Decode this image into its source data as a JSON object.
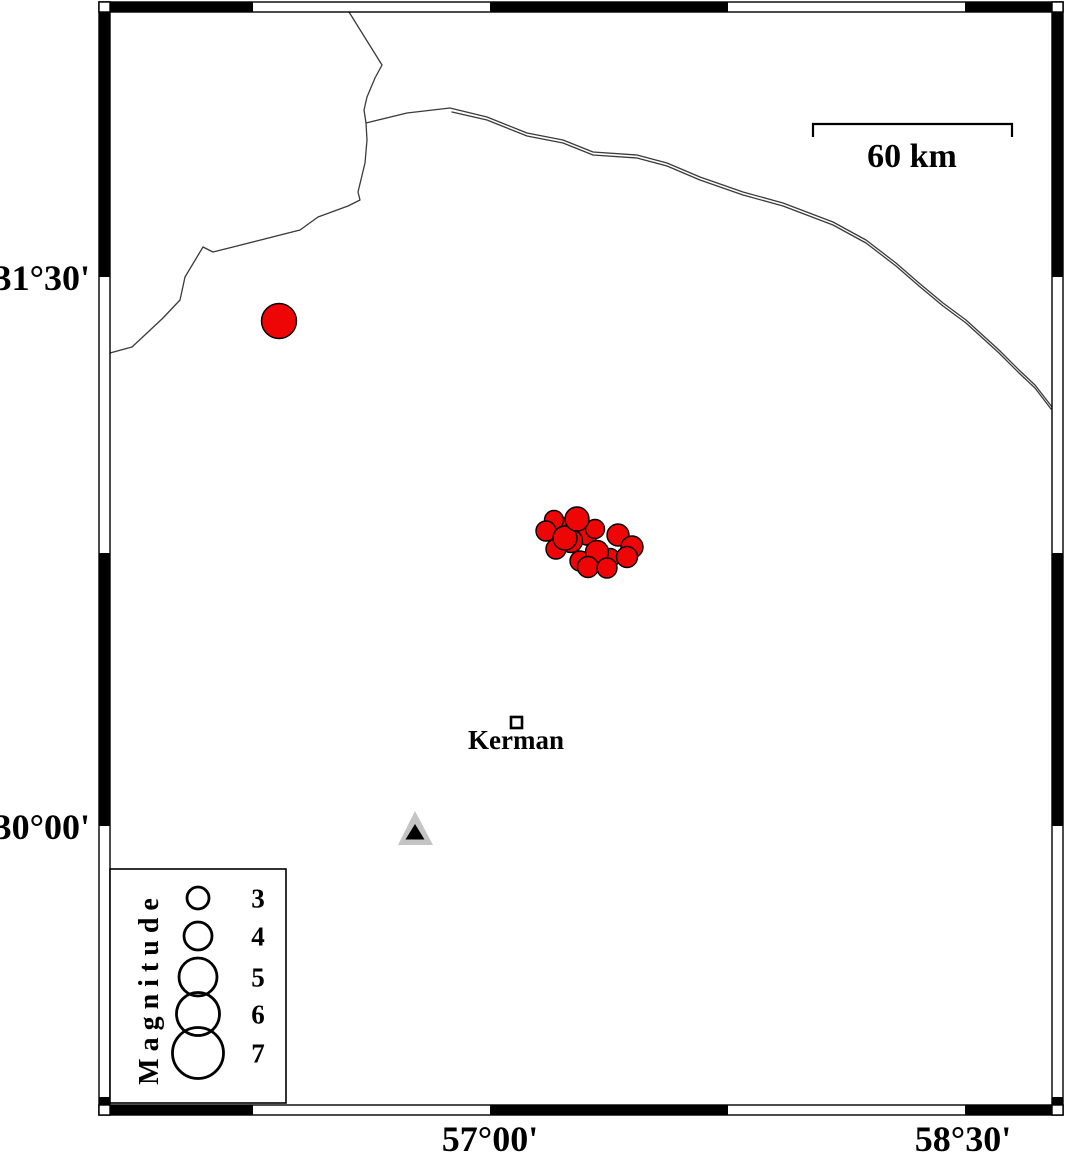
{
  "map": {
    "axis_labels": {
      "lat_top": "31°30'",
      "lat_bottom": "30°00'",
      "lon_left": "57°00'",
      "lon_right": "58°30'"
    },
    "scale_bar": {
      "label": "60 km",
      "length_km": 60,
      "x1": 813,
      "x2": 1012,
      "y": 124,
      "tick_drop": 13
    },
    "city": {
      "name": "Kerman",
      "x": 516,
      "y": 722
    },
    "station": {
      "outer": "415,811 398,845 433,845",
      "inner": "415,824 405.5,839.5 424.5,839.5"
    },
    "colors": {
      "epicenter_fill": "#ee0505",
      "station_gray": "#c4c4c4",
      "fault_line": "#3a3a3a"
    },
    "epicenters": [
      [
        279,
        321,
        17.5
      ],
      [
        561,
        527,
        9.5
      ],
      [
        554,
        520,
        9.5
      ],
      [
        546,
        531,
        10
      ],
      [
        587,
        535,
        10
      ],
      [
        595,
        529,
        9.5
      ],
      [
        571,
        541,
        11.5
      ],
      [
        556,
        549,
        10
      ],
      [
        610,
        558,
        9.5
      ],
      [
        580,
        561,
        10
      ],
      [
        565,
        538,
        12
      ],
      [
        618,
        535,
        11
      ],
      [
        632,
        547,
        11
      ],
      [
        627,
        557,
        10.5
      ],
      [
        597,
        552,
        11.5
      ],
      [
        577,
        519,
        12
      ],
      [
        588,
        567,
        10.5
      ],
      [
        607,
        568,
        10
      ]
    ],
    "faults": {
      "a": [
        [
          349,
          12
        ],
        [
          382,
          65
        ],
        [
          375,
          78
        ],
        [
          367,
          97
        ],
        [
          364,
          110
        ],
        [
          366,
          123
        ],
        [
          367,
          140
        ],
        [
          365,
          163
        ],
        [
          358,
          192
        ],
        [
          360,
          200
        ],
        [
          348,
          206
        ],
        [
          318,
          217
        ],
        [
          300,
          230
        ],
        [
          233,
          247
        ],
        [
          213,
          252
        ],
        [
          203,
          247
        ],
        [
          185,
          277
        ],
        [
          180,
          300
        ],
        [
          163,
          318
        ],
        [
          147,
          333
        ],
        [
          132,
          347
        ],
        [
          110,
          353
        ]
      ],
      "b": [
        [
          366,
          123
        ],
        [
          407,
          113
        ],
        [
          450,
          108
        ],
        [
          487,
          117
        ],
        [
          527,
          133
        ],
        [
          563,
          140
        ],
        [
          593,
          152
        ],
        [
          637,
          155
        ],
        [
          667,
          163
        ],
        [
          700,
          177
        ],
        [
          743,
          192
        ],
        [
          783,
          203
        ],
        [
          833,
          222
        ],
        [
          866,
          240
        ],
        [
          896,
          263
        ],
        [
          919,
          283
        ],
        [
          943,
          303
        ],
        [
          966,
          320
        ],
        [
          999,
          350
        ],
        [
          1019,
          370
        ],
        [
          1035,
          385
        ],
        [
          1052,
          407
        ]
      ],
      "b_parallel": [
        [
          452,
          112
        ],
        [
          487,
          120
        ],
        [
          527,
          136
        ],
        [
          563,
          143
        ],
        [
          593,
          155
        ],
        [
          637,
          158
        ],
        [
          667,
          166
        ],
        [
          700,
          180
        ],
        [
          743,
          195
        ],
        [
          783,
          206
        ],
        [
          833,
          225
        ],
        [
          866,
          243
        ],
        [
          896,
          266
        ],
        [
          919,
          286
        ],
        [
          943,
          306
        ],
        [
          966,
          323
        ],
        [
          999,
          353
        ],
        [
          1019,
          373
        ],
        [
          1035,
          388
        ],
        [
          1051,
          409
        ]
      ]
    }
  },
  "legend": {
    "title": "Magnitude",
    "entries": [
      {
        "label": "3",
        "cy": 898,
        "r": 11
      },
      {
        "label": "4",
        "cy": 936,
        "r": 14
      },
      {
        "label": "5",
        "cy": 977,
        "r": 19
      },
      {
        "label": "6",
        "cy": 1014,
        "r": 21.5
      },
      {
        "label": "7",
        "cy": 1053,
        "r": 25.5
      }
    ]
  }
}
